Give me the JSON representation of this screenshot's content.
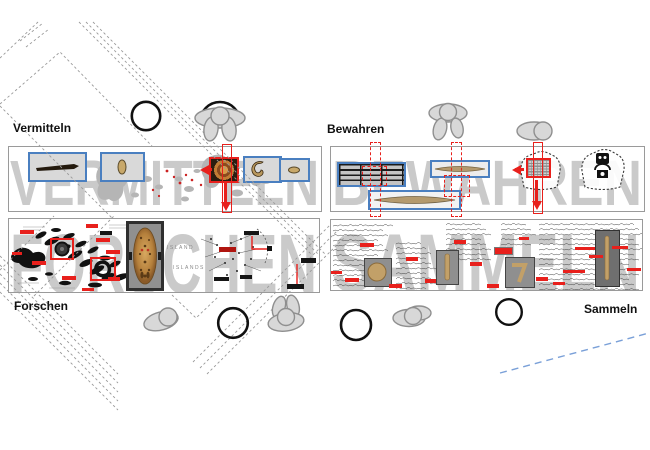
{
  "quadrants": {
    "vermitteln": {
      "label": "Vermitteln",
      "watermark": "VERMITTELN"
    },
    "bewahren": {
      "label": "Bewahren",
      "watermark": "BEWAHREN"
    },
    "forschen": {
      "label": "Forschen",
      "watermark": "FORSCHEN"
    },
    "sammeln": {
      "label": "Sammeln",
      "watermark": "SAMMELN"
    }
  },
  "map_labels": {
    "upper": "ISLAND",
    "lower": "ISLANDS"
  },
  "colors": {
    "accent_red": "#e8201c",
    "dark_red": "#b01510",
    "frame_blue": "#4a7fc0",
    "watermark_gray": "#cacaca",
    "figure_gray": "#d8d8d8",
    "artifact_tan": "#c2a068",
    "canoe_tan": "#b49a6e",
    "ink_black": "#2e2e2e",
    "boundary_blue": "#7aa0d8"
  }
}
